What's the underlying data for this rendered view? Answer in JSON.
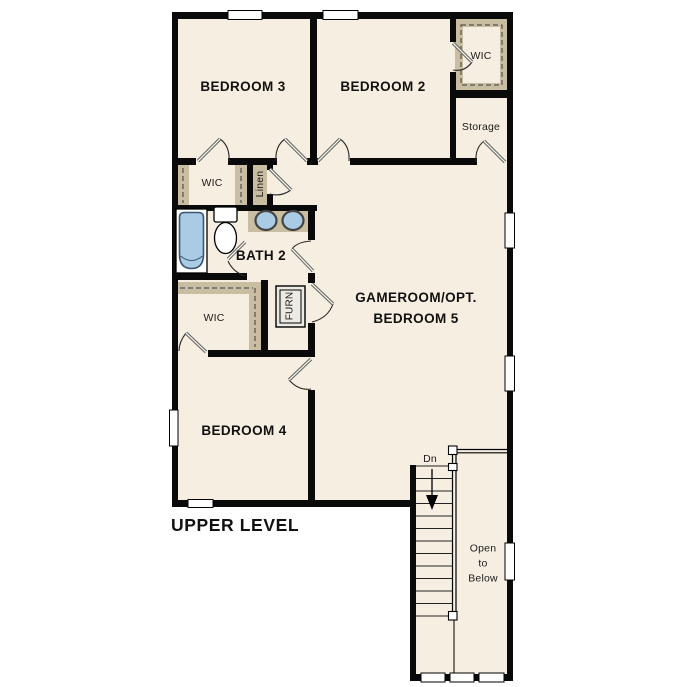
{
  "plan_title": "UPPER LEVEL",
  "colors": {
    "paper": "#ffffff",
    "floor": "#f6eee1",
    "closet_shelf": "#c9bda2",
    "wall": "#0a0a0a",
    "fixture_blue": "#a9cbe6"
  },
  "rooms": {
    "bedroom3": "BEDROOM 3",
    "bedroom2": "BEDROOM 2",
    "bedroom4": "BEDROOM 4",
    "bath2": "BATH 2",
    "gameroom": "GAMEROOM/OPT.\nBEDROOM 5"
  },
  "closets": {
    "wic_bedroom3": "WIC",
    "wic_bedroom2": "WIC",
    "wic_bedroom4": "WIC",
    "linen": "Linen",
    "storage": "Storage",
    "furnace": "FURN"
  },
  "stairs": {
    "down_label": "Dn",
    "open_to_below": "Open\nto\nBelow"
  }
}
